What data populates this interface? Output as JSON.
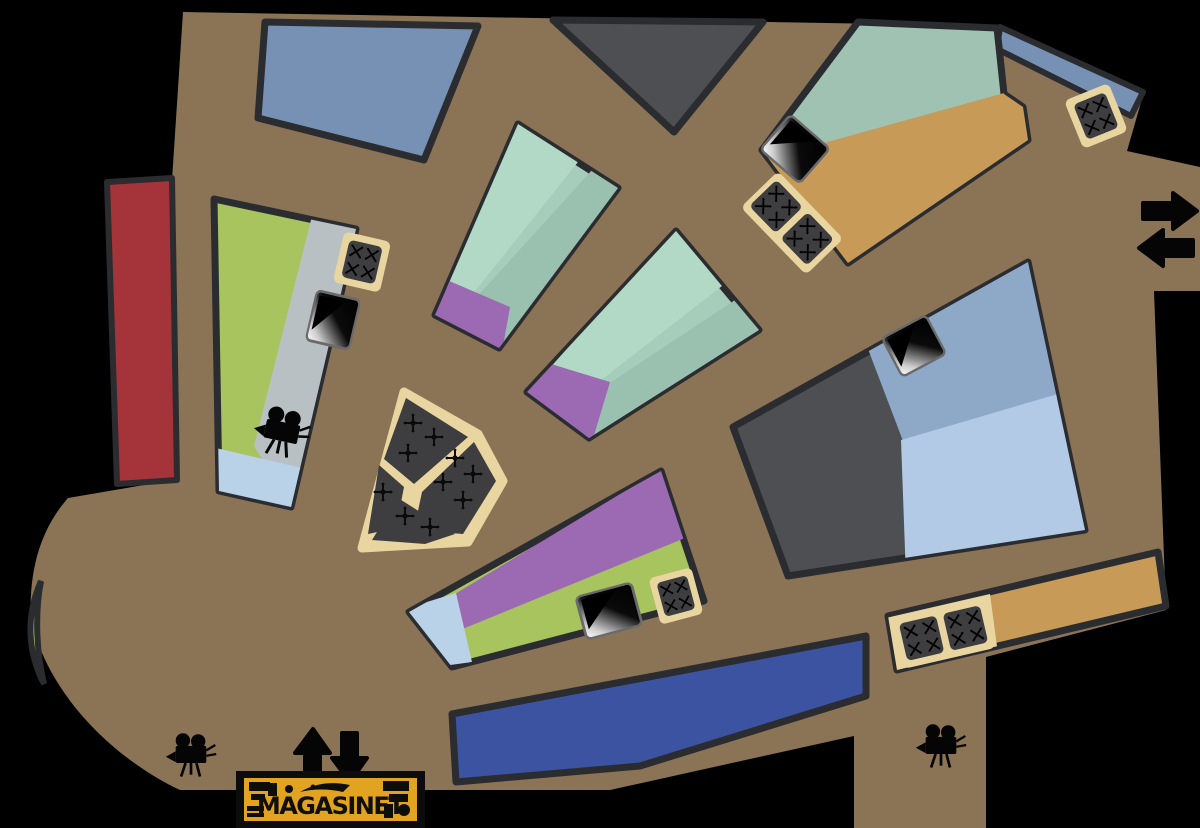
{
  "logo": {
    "text": "MAGASINET"
  },
  "colors": {
    "background": "#000000",
    "walkway": "#8b7356",
    "outline": "#2b2c30",
    "bluegray": "#7691b3",
    "darkroom": "#4e4f52",
    "teal": "#9fc2b3",
    "tan": "#c79a58",
    "red": "#a43439",
    "green": "#a7c45e",
    "gray": "#b8c0c4",
    "lightblue": "#b9d2e8",
    "mint": "#a6cdbb",
    "mint_light": "#b2d8c6",
    "mint_dark": "#9ac1b0",
    "purple": "#9c69b3",
    "navy": "#3c53a2",
    "rightblue_top": "#8ea8c8",
    "rightblue_bottom": "#b2cae6",
    "gold": "#e8d5a0",
    "fandark": "#3e3e40",
    "slivergreen": "#a6ca52",
    "iconblack": "#050505",
    "logo_yellow": "#e2a420",
    "logo_frame": "#0c0c0c"
  },
  "icons": {
    "film_camera": "film-projector silhouette",
    "arrow_up": "⬆",
    "arrow_down": "⬇",
    "arrow_right": "➡",
    "arrow_left": "⬅",
    "bench_mark": "✕",
    "seat_mark": "✛",
    "screen": "gradient display panel"
  },
  "features": {
    "camera_count": 3,
    "screen_count": 4,
    "bench_group_count": 5,
    "fan_segment_count": 4
  },
  "rooms": [
    {
      "id": "walkway",
      "color_key": "walkway"
    },
    {
      "id": "room-top-left",
      "color_key": "bluegray"
    },
    {
      "id": "room-top-center",
      "color_key": "darkroom"
    },
    {
      "id": "room-top-right",
      "color_key": "teal, tan"
    },
    {
      "id": "wall-sliver-right",
      "color_key": "bluegray"
    },
    {
      "id": "room-red",
      "color_key": "red"
    },
    {
      "id": "room-left-gallery",
      "color_key": "green, gray, lightblue"
    },
    {
      "id": "wedge-room-1",
      "color_key": "mint, purple"
    },
    {
      "id": "wedge-room-2",
      "color_key": "mint, purple"
    },
    {
      "id": "seating-fan",
      "color_key": "fandark, gold"
    },
    {
      "id": "room-purple-green",
      "color_key": "purple, green, lightblue"
    },
    {
      "id": "room-navy",
      "color_key": "navy"
    },
    {
      "id": "corridor-tan",
      "color_key": "tan, gold"
    },
    {
      "id": "room-right-large",
      "color_key": "darkroom, rightblue_top, rightblue_bottom"
    },
    {
      "id": "door-green-sliver",
      "color_key": "slivergreen"
    }
  ]
}
